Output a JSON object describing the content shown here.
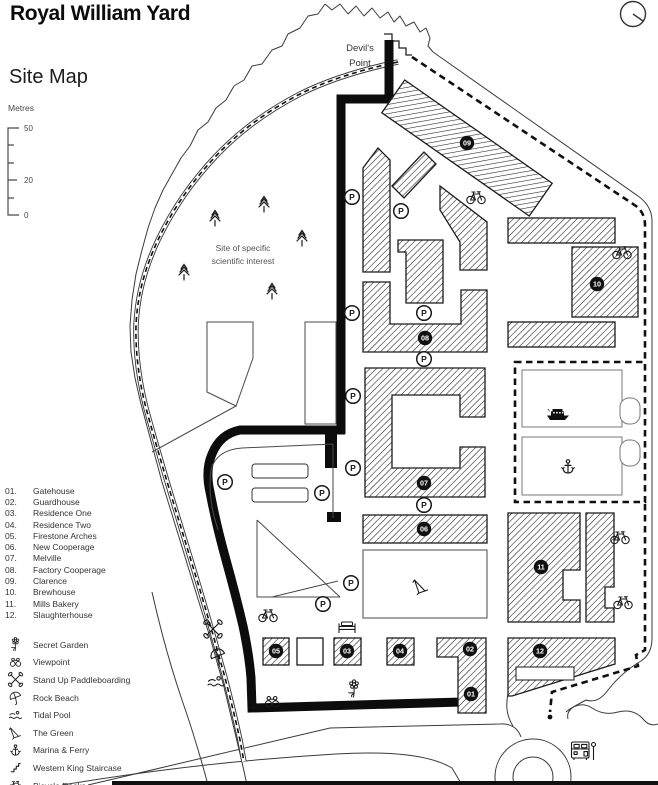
{
  "header": {
    "title": "Royal William Yard",
    "subtitle": "Site Map"
  },
  "scale": {
    "unit_label": "Metres",
    "tick_labels": [
      "50",
      "20",
      "0"
    ]
  },
  "map": {
    "labels": {
      "devils_point_line1": "Devil's",
      "devils_point_line2": "Point",
      "sssi_line1": "Site of specific",
      "sssi_line2": "scientific interest"
    },
    "parking_label": "P",
    "buildings": [
      {
        "id": "01",
        "name": "Gatehouse",
        "badge_x": 471,
        "badge_y": 694
      },
      {
        "id": "02",
        "name": "Guardhouse",
        "badge_x": 470,
        "badge_y": 649
      },
      {
        "id": "03",
        "name": "Residence One",
        "badge_x": 347,
        "badge_y": 651
      },
      {
        "id": "04",
        "name": "Residence Two",
        "badge_x": 400,
        "badge_y": 651
      },
      {
        "id": "05",
        "name": "Firestone Arches",
        "badge_x": 276,
        "badge_y": 651
      },
      {
        "id": "06",
        "name": "New Cooperage",
        "badge_x": 424,
        "badge_y": 529
      },
      {
        "id": "07",
        "name": "Melville",
        "badge_x": 424,
        "badge_y": 483
      },
      {
        "id": "08",
        "name": "Factory Cooperage",
        "badge_x": 425,
        "badge_y": 338
      },
      {
        "id": "09",
        "name": "Clarence",
        "badge_x": 467,
        "badge_y": 143
      },
      {
        "id": "10",
        "name": "Brewhouse",
        "badge_x": 597,
        "badge_y": 284
      },
      {
        "id": "11",
        "name": "Mills Bakery",
        "badge_x": 541,
        "badge_y": 567
      },
      {
        "id": "12",
        "name": "Slaughterhouse",
        "badge_x": 540,
        "badge_y": 651
      }
    ],
    "parking_positions": [
      [
        352,
        197
      ],
      [
        401,
        211
      ],
      [
        352,
        313
      ],
      [
        424,
        313
      ],
      [
        424,
        359
      ],
      [
        353,
        396
      ],
      [
        353,
        468
      ],
      [
        424,
        505
      ],
      [
        225,
        482
      ],
      [
        322,
        493
      ],
      [
        351,
        583
      ],
      [
        323,
        604
      ]
    ],
    "bike_positions": [
      [
        476,
        197
      ],
      [
        622,
        252
      ],
      [
        620,
        537
      ],
      [
        623,
        602
      ],
      [
        268,
        615
      ]
    ],
    "tree_positions": [
      [
        215,
        218
      ],
      [
        264,
        204
      ],
      [
        302,
        238
      ],
      [
        184,
        272
      ],
      [
        272,
        291
      ]
    ],
    "feature_markers": [
      {
        "icon": "paddles",
        "x": 213,
        "y": 629
      },
      {
        "icon": "umbrella",
        "x": 218,
        "y": 656
      },
      {
        "icon": "swimmer",
        "x": 216,
        "y": 682
      },
      {
        "icon": "binoculars",
        "x": 272,
        "y": 702
      },
      {
        "icon": "flower",
        "x": 354,
        "y": 689
      },
      {
        "icon": "bed",
        "x": 347,
        "y": 628
      },
      {
        "icon": "deckchair",
        "x": 421,
        "y": 586
      },
      {
        "icon": "ferry",
        "x": 558,
        "y": 414
      },
      {
        "icon": "anchor",
        "x": 568,
        "y": 467
      },
      {
        "icon": "bus",
        "x": 581,
        "y": 751
      }
    ]
  },
  "legend": {
    "features": [
      {
        "icon": "flower",
        "label": "Secret Garden"
      },
      {
        "icon": "binoculars",
        "label": "Viewpoint"
      },
      {
        "icon": "paddles",
        "label": "Stand Up Paddleboarding"
      },
      {
        "icon": "umbrella",
        "label": "Rock Beach"
      },
      {
        "icon": "swimmer",
        "label": "Tidal Pool"
      },
      {
        "icon": "deckchair",
        "label": "The Green"
      },
      {
        "icon": "anchor",
        "label": "Marina & Ferry"
      },
      {
        "icon": "stairs",
        "label": "Western King Staircase"
      },
      {
        "icon": "bicycle",
        "label": "Bicycle Racks"
      }
    ]
  },
  "colors": {
    "ink": "#1a1a1a",
    "muted": "#4a4a4a",
    "path": "#111111"
  }
}
